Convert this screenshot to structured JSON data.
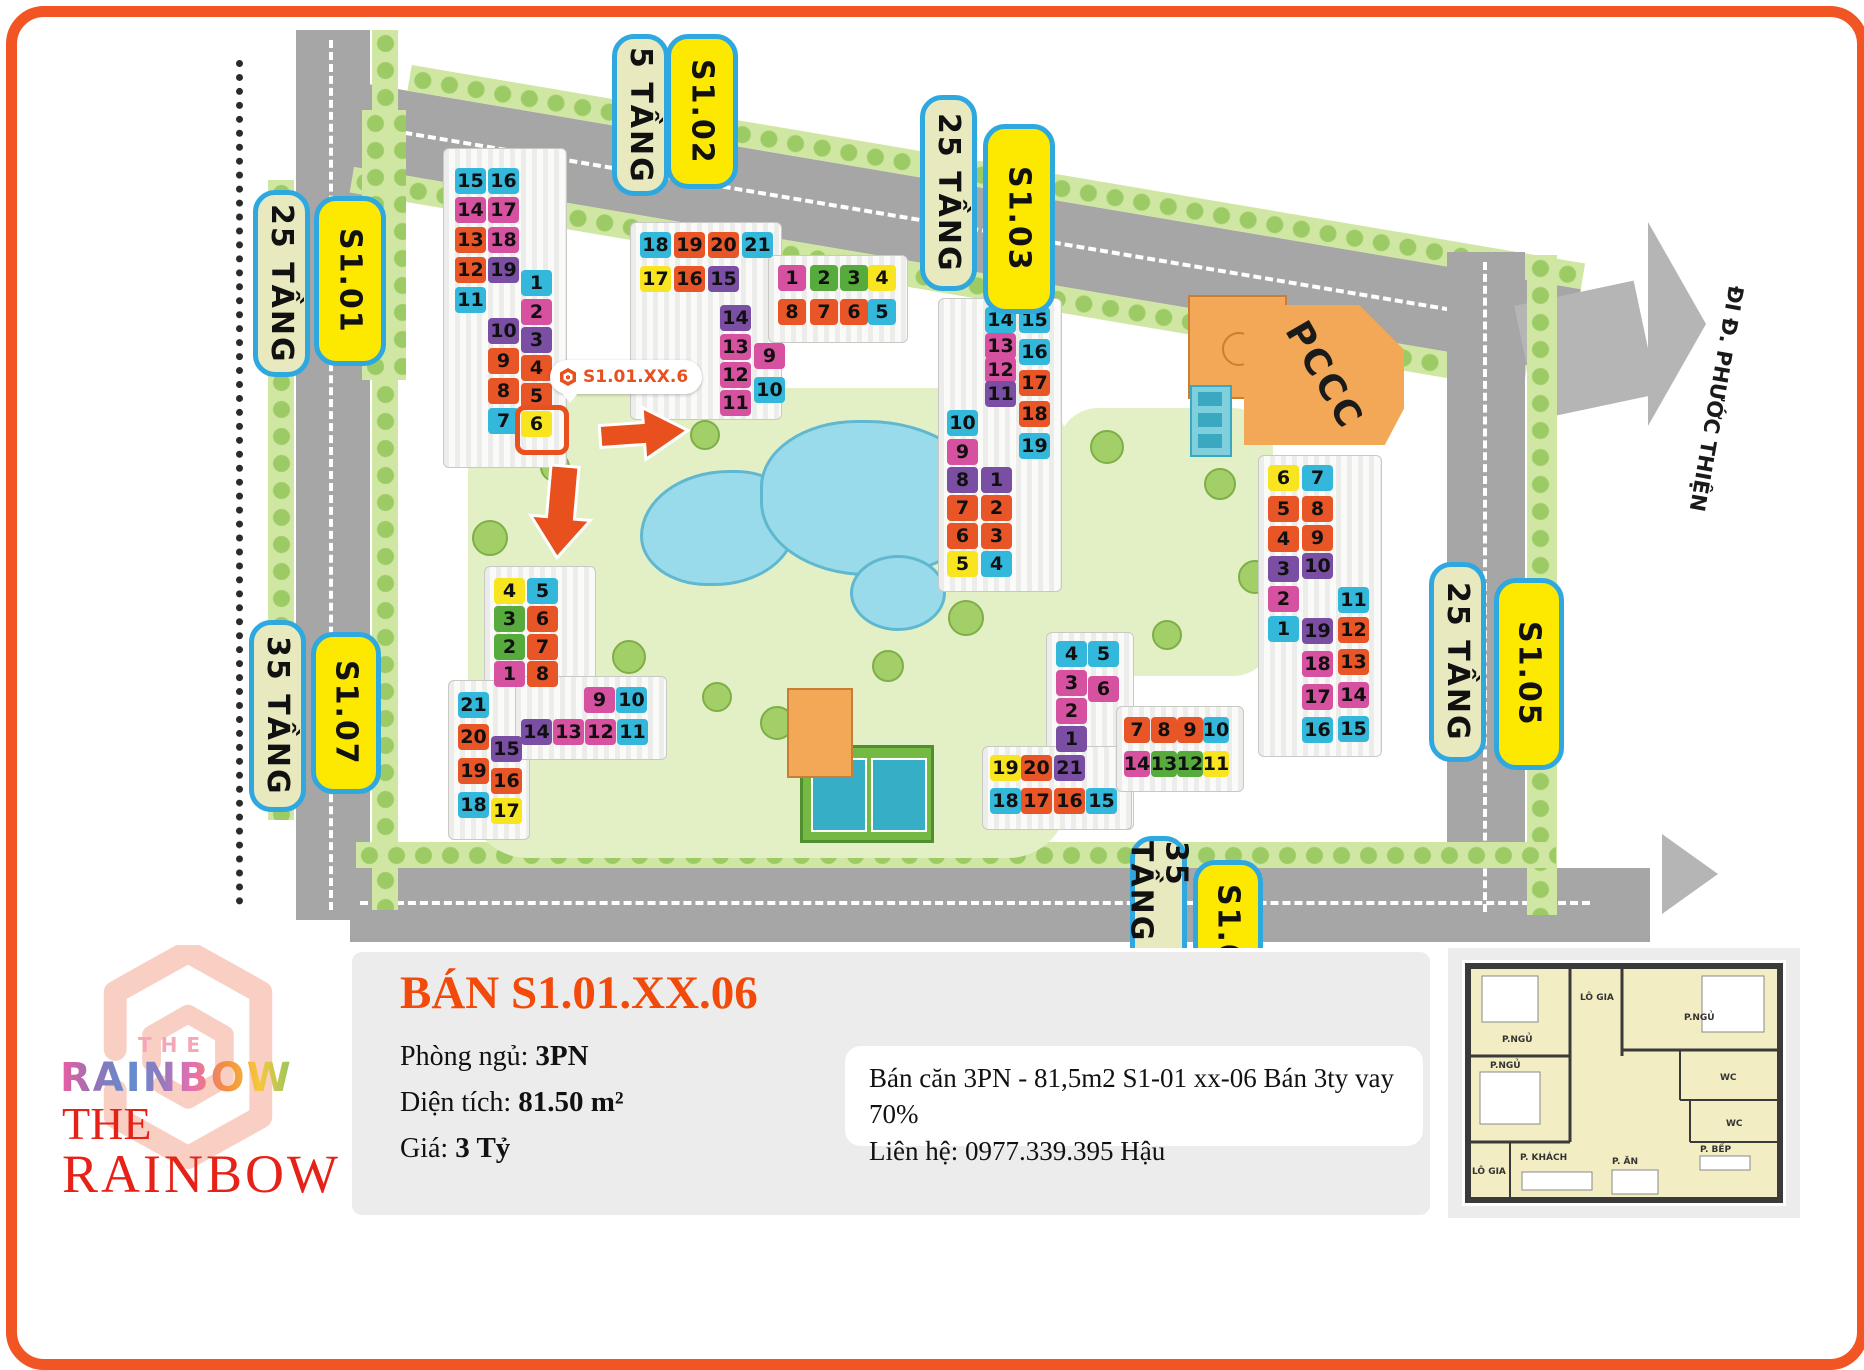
{
  "frame": {
    "border_color": "#f05523"
  },
  "map": {
    "unit_colors": {
      "C": "#33b8dc",
      "P": "#d6519f",
      "O": "#e85527",
      "U": "#7a4ea3",
      "Y": "#f8e51f",
      "G": "#57ab3c"
    },
    "pill_colors": {
      "beige": "#e9e9c0",
      "yellow": "#fde900",
      "border": "#2fa8e0"
    },
    "highlight_color": "#e8501e",
    "callout": {
      "text": "S1.01.XX.6"
    },
    "street_label": "ĐI Đ. PHƯỚC THIỆN",
    "pccc_label": "PCCC",
    "pills": [
      {
        "text": "25 TẦNG",
        "style": "beige",
        "x": 253,
        "y": 190,
        "len": 187,
        "w": 57
      },
      {
        "text": "S1.01",
        "style": "yellow",
        "x": 314,
        "y": 196,
        "len": 170,
        "w": 72
      },
      {
        "text": "5 TẦNG",
        "style": "beige",
        "x": 612,
        "y": 34,
        "len": 162,
        "w": 57
      },
      {
        "text": "S1.02",
        "style": "yellow",
        "x": 666,
        "y": 34,
        "len": 155,
        "w": 72
      },
      {
        "text": "25 TẦNG",
        "style": "beige",
        "x": 920,
        "y": 95,
        "len": 196,
        "w": 57
      },
      {
        "text": "S1.03",
        "style": "yellow",
        "x": 983,
        "y": 124,
        "len": 190,
        "w": 72
      },
      {
        "text": "35 TẦNG",
        "style": "beige",
        "x": 249,
        "y": 620,
        "len": 192,
        "w": 57
      },
      {
        "text": "S1.07",
        "style": "yellow",
        "x": 311,
        "y": 632,
        "len": 162,
        "w": 70
      },
      {
        "text": "25 TẦNG",
        "style": "beige",
        "x": 1429,
        "y": 562,
        "len": 200,
        "w": 57
      },
      {
        "text": "S1.05",
        "style": "yellow",
        "x": 1494,
        "y": 578,
        "len": 192,
        "w": 70
      },
      {
        "text": "35 TẦNG",
        "style": "beige",
        "x": 1130,
        "y": 836,
        "len": 150,
        "w": 57
      },
      {
        "text": "S1.0",
        "style": "yellow",
        "x": 1193,
        "y": 860,
        "len": 130,
        "w": 70
      }
    ],
    "footprints": [
      {
        "x": 443,
        "y": 148,
        "w": 122,
        "h": 318
      },
      {
        "x": 630,
        "y": 222,
        "w": 150,
        "h": 196
      },
      {
        "x": 768,
        "y": 255,
        "w": 138,
        "h": 86
      },
      {
        "x": 938,
        "y": 298,
        "w": 122,
        "h": 292
      },
      {
        "x": 1258,
        "y": 455,
        "w": 122,
        "h": 300
      },
      {
        "x": 484,
        "y": 566,
        "w": 110,
        "h": 128
      },
      {
        "x": 448,
        "y": 680,
        "w": 80,
        "h": 158
      },
      {
        "x": 515,
        "y": 676,
        "w": 150,
        "h": 82
      },
      {
        "x": 1046,
        "y": 632,
        "w": 86,
        "h": 196
      },
      {
        "x": 982,
        "y": 746,
        "w": 148,
        "h": 82
      },
      {
        "x": 1116,
        "y": 706,
        "w": 126,
        "h": 84
      }
    ],
    "units": [
      {
        "b": "S1.01",
        "n": 15,
        "c": "C",
        "x": 455,
        "y": 168
      },
      {
        "b": "S1.01",
        "n": 16,
        "c": "C",
        "x": 488,
        "y": 168
      },
      {
        "b": "S1.01",
        "n": 14,
        "c": "P",
        "x": 455,
        "y": 197
      },
      {
        "b": "S1.01",
        "n": 17,
        "c": "P",
        "x": 488,
        "y": 197
      },
      {
        "b": "S1.01",
        "n": 13,
        "c": "O",
        "x": 455,
        "y": 227
      },
      {
        "b": "S1.01",
        "n": 18,
        "c": "P",
        "x": 488,
        "y": 227
      },
      {
        "b": "S1.01",
        "n": 12,
        "c": "O",
        "x": 455,
        "y": 257
      },
      {
        "b": "S1.01",
        "n": 19,
        "c": "U",
        "x": 488,
        "y": 257
      },
      {
        "b": "S1.01",
        "n": 11,
        "c": "C",
        "x": 455,
        "y": 287
      },
      {
        "b": "S1.01",
        "n": 1,
        "c": "C",
        "x": 521,
        "y": 270
      },
      {
        "b": "S1.01",
        "n": 10,
        "c": "U",
        "x": 488,
        "y": 318
      },
      {
        "b": "S1.01",
        "n": 2,
        "c": "P",
        "x": 521,
        "y": 299
      },
      {
        "b": "S1.01",
        "n": 9,
        "c": "O",
        "x": 488,
        "y": 348
      },
      {
        "b": "S1.01",
        "n": 3,
        "c": "U",
        "x": 521,
        "y": 327
      },
      {
        "b": "S1.01",
        "n": 8,
        "c": "O",
        "x": 488,
        "y": 378
      },
      {
        "b": "S1.01",
        "n": 4,
        "c": "O",
        "x": 521,
        "y": 355
      },
      {
        "b": "S1.01",
        "n": 7,
        "c": "C",
        "x": 488,
        "y": 408
      },
      {
        "b": "S1.01",
        "n": 5,
        "c": "O",
        "x": 521,
        "y": 383
      },
      {
        "b": "S1.01",
        "n": 6,
        "c": "Y",
        "x": 521,
        "y": 411,
        "hl": true
      },
      {
        "b": "S1.02",
        "n": 18,
        "c": "C",
        "x": 640,
        "y": 232
      },
      {
        "b": "S1.02",
        "n": 19,
        "c": "O",
        "x": 674,
        "y": 232
      },
      {
        "b": "S1.02",
        "n": 20,
        "c": "O",
        "x": 708,
        "y": 232
      },
      {
        "b": "S1.02",
        "n": 21,
        "c": "C",
        "x": 742,
        "y": 232
      },
      {
        "b": "S1.02",
        "n": 17,
        "c": "Y",
        "x": 640,
        "y": 266
      },
      {
        "b": "S1.02",
        "n": 16,
        "c": "O",
        "x": 674,
        "y": 266
      },
      {
        "b": "S1.02",
        "n": 15,
        "c": "U",
        "x": 708,
        "y": 266
      },
      {
        "b": "S1.02",
        "n": 14,
        "c": "U",
        "x": 720,
        "y": 305
      },
      {
        "b": "S1.02",
        "n": 13,
        "c": "P",
        "x": 720,
        "y": 334
      },
      {
        "b": "S1.02",
        "n": 12,
        "c": "P",
        "x": 720,
        "y": 362
      },
      {
        "b": "S1.02",
        "n": 11,
        "c": "P",
        "x": 720,
        "y": 390
      },
      {
        "b": "S1.02",
        "n": 9,
        "c": "P",
        "x": 754,
        "y": 343
      },
      {
        "b": "S1.02",
        "n": 10,
        "c": "C",
        "x": 754,
        "y": 377
      },
      {
        "b": "S1.02",
        "n": 1,
        "c": "P",
        "x": 778,
        "y": 265,
        "w": 28
      },
      {
        "b": "S1.02",
        "n": 2,
        "c": "G",
        "x": 810,
        "y": 265,
        "w": 28
      },
      {
        "b": "S1.02",
        "n": 3,
        "c": "G",
        "x": 840,
        "y": 265,
        "w": 28
      },
      {
        "b": "S1.02",
        "n": 4,
        "c": "Y",
        "x": 868,
        "y": 265,
        "w": 28
      },
      {
        "b": "S1.02",
        "n": 8,
        "c": "O",
        "x": 778,
        "y": 299,
        "w": 28
      },
      {
        "b": "S1.02",
        "n": 7,
        "c": "O",
        "x": 810,
        "y": 299,
        "w": 28
      },
      {
        "b": "S1.02",
        "n": 6,
        "c": "O",
        "x": 840,
        "y": 299,
        "w": 28
      },
      {
        "b": "S1.02",
        "n": 5,
        "c": "C",
        "x": 868,
        "y": 299,
        "w": 28
      },
      {
        "b": "S1.03",
        "n": 14,
        "c": "C",
        "x": 985,
        "y": 307
      },
      {
        "b": "S1.03",
        "n": 15,
        "c": "C",
        "x": 1019,
        "y": 307
      },
      {
        "b": "S1.03",
        "n": 13,
        "c": "P",
        "x": 985,
        "y": 333
      },
      {
        "b": "S1.03",
        "n": 16,
        "c": "C",
        "x": 1019,
        "y": 339
      },
      {
        "b": "S1.03",
        "n": 12,
        "c": "P",
        "x": 985,
        "y": 357
      },
      {
        "b": "S1.03",
        "n": 17,
        "c": "O",
        "x": 1019,
        "y": 370
      },
      {
        "b": "S1.03",
        "n": 11,
        "c": "U",
        "x": 985,
        "y": 381
      },
      {
        "b": "S1.03",
        "n": 18,
        "c": "O",
        "x": 1019,
        "y": 401
      },
      {
        "b": "S1.03",
        "n": 19,
        "c": "C",
        "x": 1019,
        "y": 433
      },
      {
        "b": "S1.03",
        "n": 10,
        "c": "C",
        "x": 947,
        "y": 410
      },
      {
        "b": "S1.03",
        "n": 9,
        "c": "P",
        "x": 947,
        "y": 439
      },
      {
        "b": "S1.03",
        "n": 8,
        "c": "U",
        "x": 947,
        "y": 467
      },
      {
        "b": "S1.03",
        "n": 7,
        "c": "O",
        "x": 947,
        "y": 495
      },
      {
        "b": "S1.03",
        "n": 6,
        "c": "O",
        "x": 947,
        "y": 523
      },
      {
        "b": "S1.03",
        "n": 5,
        "c": "Y",
        "x": 947,
        "y": 551
      },
      {
        "b": "S1.03",
        "n": 1,
        "c": "U",
        "x": 981,
        "y": 467
      },
      {
        "b": "S1.03",
        "n": 2,
        "c": "O",
        "x": 981,
        "y": 495
      },
      {
        "b": "S1.03",
        "n": 3,
        "c": "O",
        "x": 981,
        "y": 523
      },
      {
        "b": "S1.03",
        "n": 4,
        "c": "C",
        "x": 981,
        "y": 551
      },
      {
        "b": "S1.05",
        "n": 6,
        "c": "Y",
        "x": 1268,
        "y": 465
      },
      {
        "b": "S1.05",
        "n": 7,
        "c": "C",
        "x": 1302,
        "y": 465
      },
      {
        "b": "S1.05",
        "n": 5,
        "c": "O",
        "x": 1268,
        "y": 496
      },
      {
        "b": "S1.05",
        "n": 8,
        "c": "O",
        "x": 1302,
        "y": 496
      },
      {
        "b": "S1.05",
        "n": 4,
        "c": "O",
        "x": 1268,
        "y": 526
      },
      {
        "b": "S1.05",
        "n": 9,
        "c": "O",
        "x": 1302,
        "y": 525
      },
      {
        "b": "S1.05",
        "n": 3,
        "c": "U",
        "x": 1268,
        "y": 556
      },
      {
        "b": "S1.05",
        "n": 10,
        "c": "U",
        "x": 1302,
        "y": 553
      },
      {
        "b": "S1.05",
        "n": 2,
        "c": "P",
        "x": 1268,
        "y": 586
      },
      {
        "b": "S1.05",
        "n": 1,
        "c": "C",
        "x": 1268,
        "y": 616
      },
      {
        "b": "S1.05",
        "n": 11,
        "c": "C",
        "x": 1338,
        "y": 587
      },
      {
        "b": "S1.05",
        "n": 19,
        "c": "U",
        "x": 1302,
        "y": 618
      },
      {
        "b": "S1.05",
        "n": 12,
        "c": "O",
        "x": 1338,
        "y": 617
      },
      {
        "b": "S1.05",
        "n": 18,
        "c": "P",
        "x": 1302,
        "y": 651
      },
      {
        "b": "S1.05",
        "n": 13,
        "c": "O",
        "x": 1338,
        "y": 649
      },
      {
        "b": "S1.05",
        "n": 17,
        "c": "P",
        "x": 1302,
        "y": 684
      },
      {
        "b": "S1.05",
        "n": 14,
        "c": "P",
        "x": 1338,
        "y": 682
      },
      {
        "b": "S1.05",
        "n": 16,
        "c": "C",
        "x": 1302,
        "y": 717
      },
      {
        "b": "S1.05",
        "n": 15,
        "c": "C",
        "x": 1338,
        "y": 716
      },
      {
        "b": "S1.07",
        "n": 4,
        "c": "Y",
        "x": 494,
        "y": 578
      },
      {
        "b": "S1.07",
        "n": 5,
        "c": "C",
        "x": 527,
        "y": 578
      },
      {
        "b": "S1.07",
        "n": 3,
        "c": "G",
        "x": 494,
        "y": 606
      },
      {
        "b": "S1.07",
        "n": 6,
        "c": "O",
        "x": 527,
        "y": 606
      },
      {
        "b": "S1.07",
        "n": 2,
        "c": "G",
        "x": 494,
        "y": 634
      },
      {
        "b": "S1.07",
        "n": 7,
        "c": "O",
        "x": 527,
        "y": 634
      },
      {
        "b": "S1.07",
        "n": 1,
        "c": "P",
        "x": 494,
        "y": 661
      },
      {
        "b": "S1.07",
        "n": 8,
        "c": "O",
        "x": 527,
        "y": 661
      },
      {
        "b": "S1.07",
        "n": 9,
        "c": "P",
        "x": 584,
        "y": 687
      },
      {
        "b": "S1.07",
        "n": 10,
        "c": "C",
        "x": 616,
        "y": 687
      },
      {
        "b": "S1.07",
        "n": 14,
        "c": "U",
        "x": 521,
        "y": 719
      },
      {
        "b": "S1.07",
        "n": 13,
        "c": "P",
        "x": 553,
        "y": 719
      },
      {
        "b": "S1.07",
        "n": 12,
        "c": "P",
        "x": 585,
        "y": 719
      },
      {
        "b": "S1.07",
        "n": 11,
        "c": "C",
        "x": 617,
        "y": 719
      },
      {
        "b": "S1.07",
        "n": 21,
        "c": "C",
        "x": 458,
        "y": 692
      },
      {
        "b": "S1.07",
        "n": 20,
        "c": "O",
        "x": 458,
        "y": 724
      },
      {
        "b": "S1.07",
        "n": 19,
        "c": "O",
        "x": 458,
        "y": 758
      },
      {
        "b": "S1.07",
        "n": 18,
        "c": "C",
        "x": 458,
        "y": 792
      },
      {
        "b": "S1.07",
        "n": 15,
        "c": "U",
        "x": 491,
        "y": 736
      },
      {
        "b": "S1.07",
        "n": 16,
        "c": "O",
        "x": 491,
        "y": 768
      },
      {
        "b": "S1.07",
        "n": 17,
        "c": "Y",
        "x": 491,
        "y": 798
      },
      {
        "b": "S1.0x",
        "n": 4,
        "c": "C",
        "x": 1056,
        "y": 641
      },
      {
        "b": "S1.0x",
        "n": 5,
        "c": "C",
        "x": 1088,
        "y": 641
      },
      {
        "b": "S1.0x",
        "n": 3,
        "c": "P",
        "x": 1056,
        "y": 670
      },
      {
        "b": "S1.0x",
        "n": 6,
        "c": "P",
        "x": 1088,
        "y": 676
      },
      {
        "b": "S1.0x",
        "n": 2,
        "c": "P",
        "x": 1056,
        "y": 698
      },
      {
        "b": "S1.0x",
        "n": 1,
        "c": "U",
        "x": 1056,
        "y": 726
      },
      {
        "b": "S1.0x",
        "n": 19,
        "c": "Y",
        "x": 990,
        "y": 755
      },
      {
        "b": "S1.0x",
        "n": 20,
        "c": "O",
        "x": 1021,
        "y": 755
      },
      {
        "b": "S1.0x",
        "n": 21,
        "c": "U",
        "x": 1054,
        "y": 755
      },
      {
        "b": "S1.0x",
        "n": 18,
        "c": "C",
        "x": 990,
        "y": 788
      },
      {
        "b": "S1.0x",
        "n": 17,
        "c": "O",
        "x": 1021,
        "y": 788
      },
      {
        "b": "S1.0x",
        "n": 16,
        "c": "O",
        "x": 1054,
        "y": 788
      },
      {
        "b": "S1.0x",
        "n": 15,
        "c": "C",
        "x": 1086,
        "y": 788
      },
      {
        "b": "S1.0x",
        "n": 7,
        "c": "O",
        "x": 1124,
        "y": 717,
        "w": 26
      },
      {
        "b": "S1.0x",
        "n": 8,
        "c": "O",
        "x": 1151,
        "y": 717,
        "w": 26
      },
      {
        "b": "S1.0x",
        "n": 9,
        "c": "O",
        "x": 1177,
        "y": 717,
        "w": 26
      },
      {
        "b": "S1.0x",
        "n": 10,
        "c": "C",
        "x": 1203,
        "y": 717,
        "w": 26
      },
      {
        "b": "S1.0x",
        "n": 14,
        "c": "P",
        "x": 1124,
        "y": 751,
        "w": 26
      },
      {
        "b": "S1.0x",
        "n": 13,
        "c": "G",
        "x": 1151,
        "y": 751,
        "w": 26
      },
      {
        "b": "S1.0x",
        "n": 12,
        "c": "G",
        "x": 1177,
        "y": 751,
        "w": 26
      },
      {
        "b": "S1.0x",
        "n": 11,
        "c": "Y",
        "x": 1203,
        "y": 751,
        "w": 26
      }
    ]
  },
  "panel": {
    "title": "BÁN S1.01.XX.06",
    "fields": [
      {
        "label": "Phòng ngủ:",
        "value": "3PN"
      },
      {
        "label": "Diện tích:",
        "value": "81.50 m²"
      },
      {
        "label": "Giá:",
        "value": "3 Tỷ"
      }
    ],
    "description": [
      "Bán căn 3PN - 81,5m2 S1-01 xx-06 Bán 3ty vay 70%",
      "Liên hệ: 0977.339.395 Hậu"
    ]
  },
  "logo": {
    "the_small": "THE",
    "rainbow_gradient": "RAINBOW",
    "the_red": "THE",
    "rainbow_red": "RAINBOW"
  },
  "floorplan": {
    "rooms": [
      "P.NGỦ",
      "LÔ GIA",
      "P.NGỦ",
      "P.NGỦ",
      "WC",
      "WC",
      "P. KHÁCH",
      "P. ĂN",
      "P. BẾP",
      "LÔ GIA"
    ]
  }
}
